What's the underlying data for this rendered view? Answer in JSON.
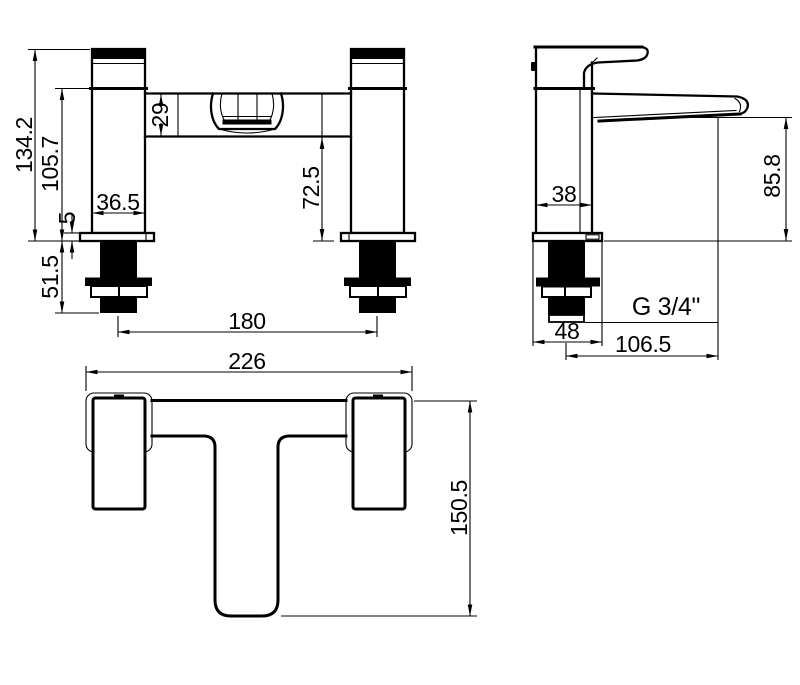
{
  "drawing": {
    "type": "technical-dimension-drawing",
    "subject": "bath filler tap - three orthographic views",
    "colors": {
      "line": "#000000",
      "background": "#ffffff"
    },
    "views": {
      "front": {
        "dims": {
          "total_height": "134.2",
          "body_height": "105.7",
          "below_deck": "51.5",
          "plate_thickness": "5",
          "body_width": "36.5",
          "crossbar_height": "29",
          "crossbar_to_deck": "72.5",
          "tap_centres": "180"
        }
      },
      "side": {
        "dims": {
          "body_depth": "38",
          "spout_height": "85.8",
          "plate_depth": "48",
          "spout_reach": "106.5"
        },
        "thread_label": "G 3/4\""
      },
      "plan": {
        "dims": {
          "overall_width": "226",
          "overall_depth": "150.5"
        }
      }
    }
  }
}
